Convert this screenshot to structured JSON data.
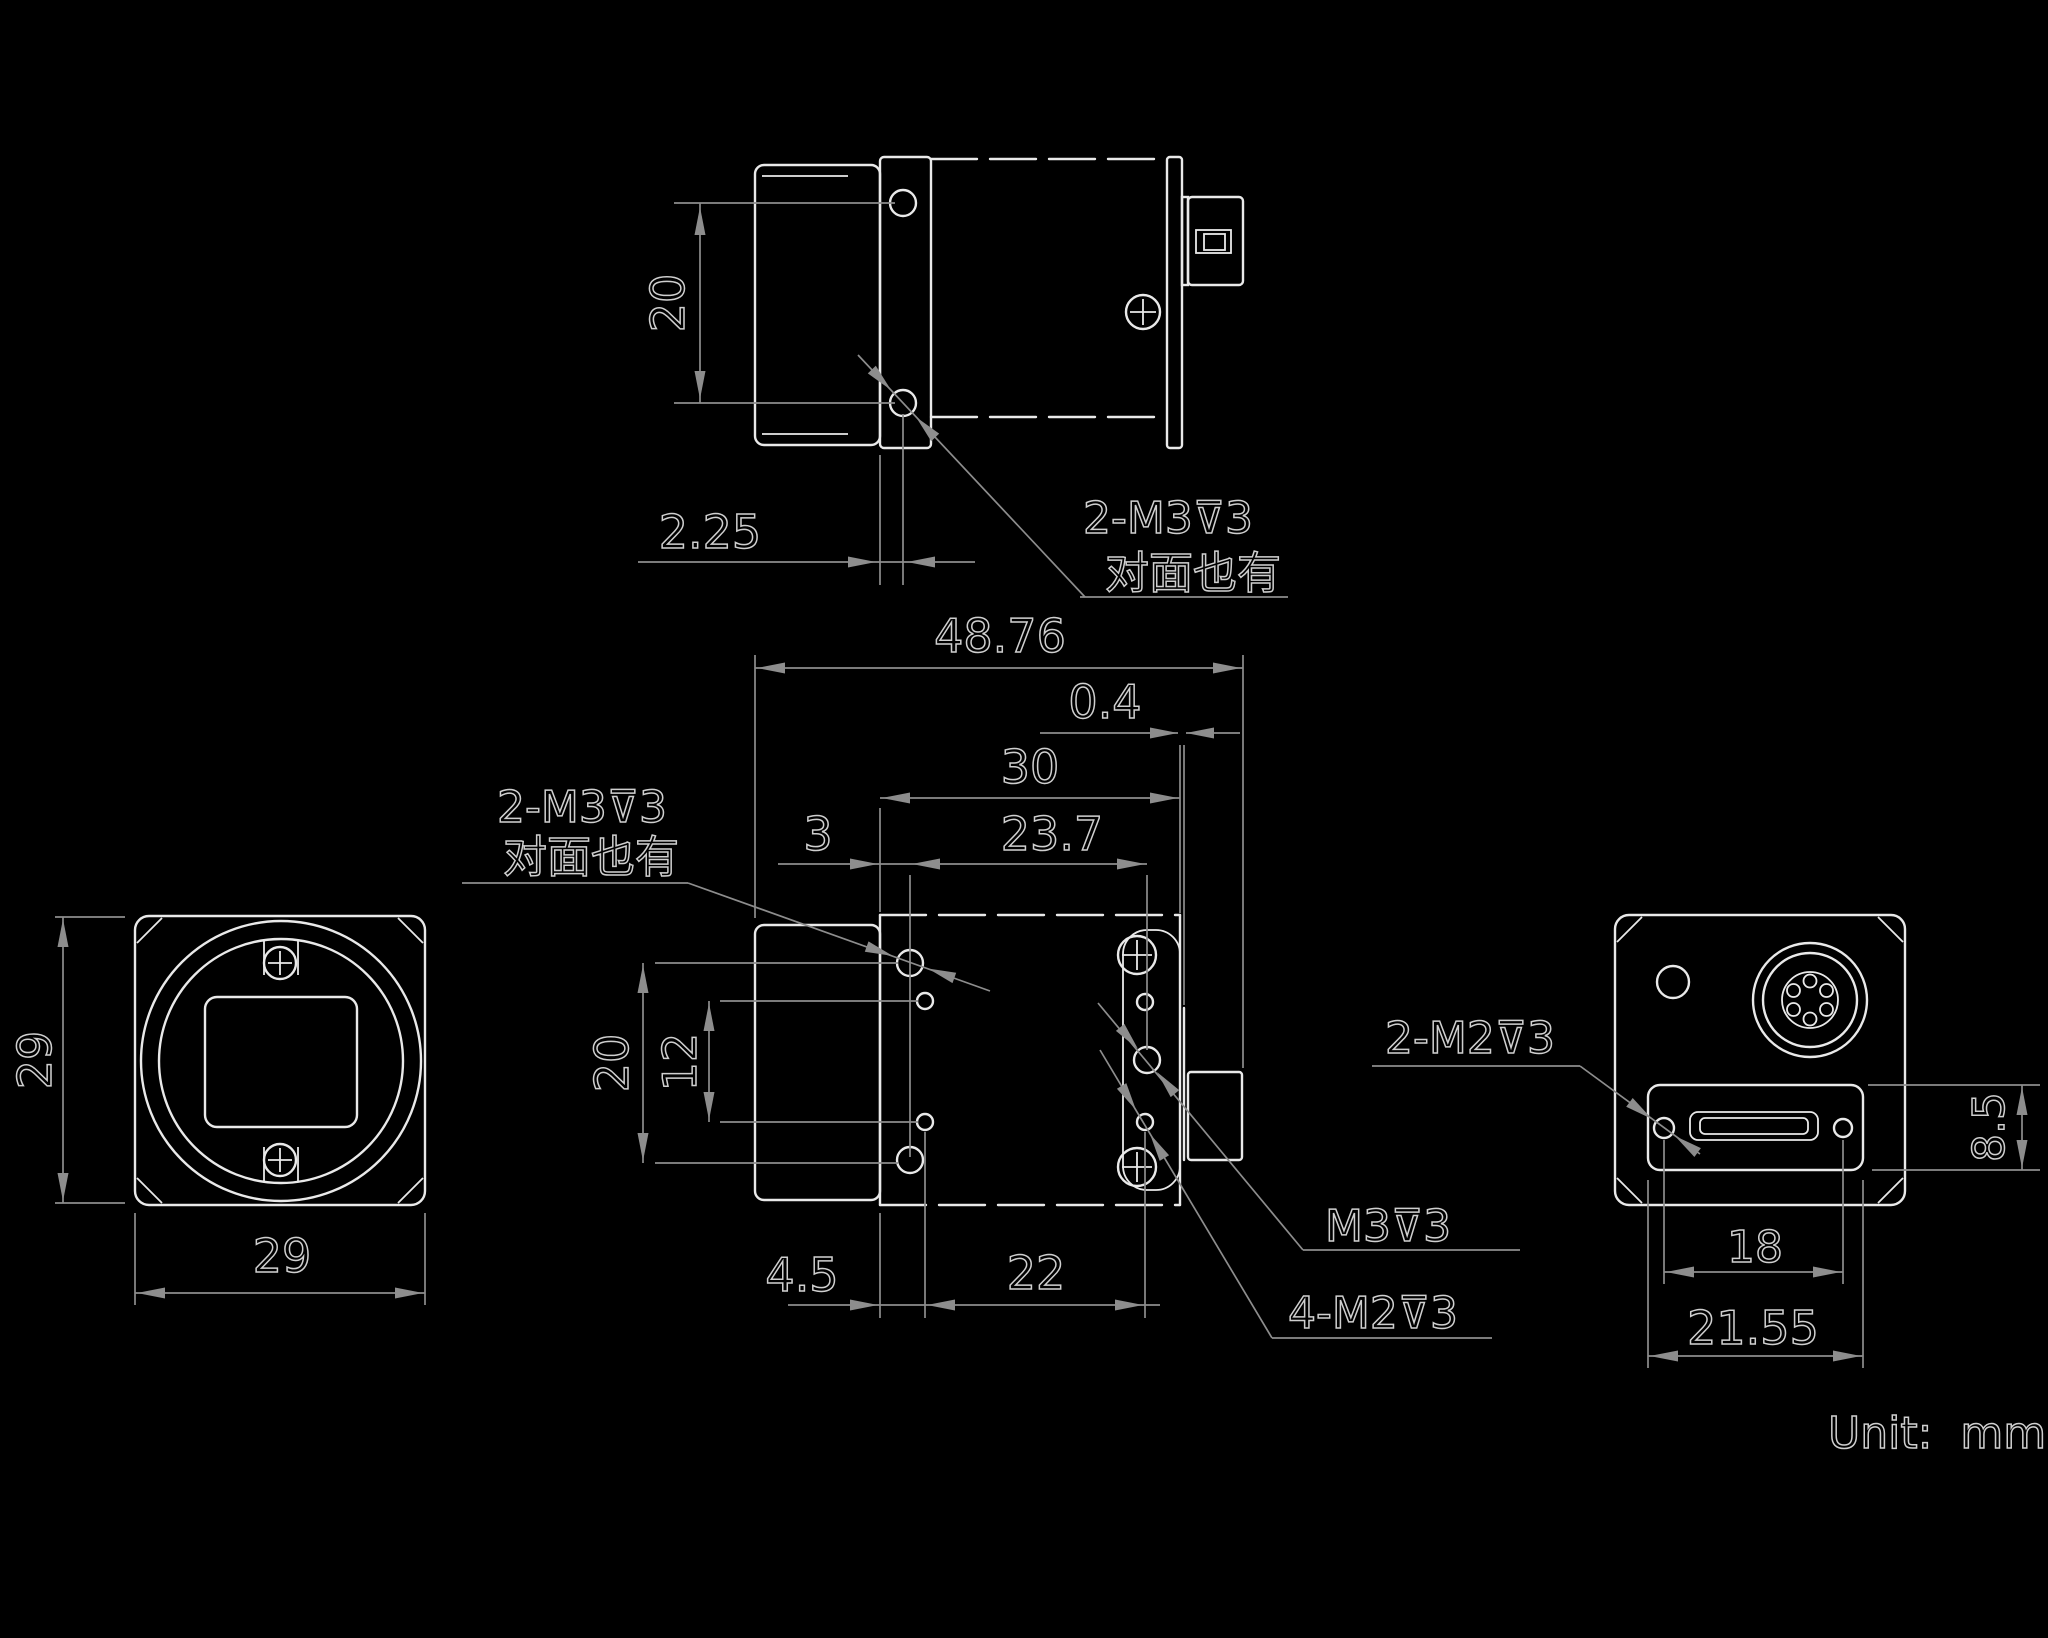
{
  "drawing": {
    "unit_note": "Unit:  mm",
    "top_view": {
      "dim_hole_span_v": "20",
      "dim_hole_offset": "2.25",
      "thread_label": "2-M3⊽3",
      "thread_note": "对面也有"
    },
    "side_view": {
      "dim_total_length": "48.76",
      "dim_rear_plate": "0.4",
      "dim_body_length": "30",
      "dim_m3_span_h": "23.7",
      "dim_front_plate": "3",
      "dim_m3_span_v": "20",
      "dim_m2_span_v": "12",
      "dim_m2_offset": "4.5",
      "dim_m2_span_h": "22",
      "thread_label": "2-M3⊽3",
      "thread_note": "对面也有",
      "m3_label": "M3⊽3",
      "m2_label": "4-M2⊽3"
    },
    "front_view": {
      "dim_height": "29",
      "dim_width": "29"
    },
    "back_view": {
      "dim_recess_height": "8.5",
      "dim_screw_span": "18",
      "dim_recess_width": "21.55",
      "thread_label": "2-M2⊽3"
    },
    "colors": {
      "background": "#000000",
      "object_line": "#e9e9e9",
      "dimension_line": "#8d8d8d",
      "text": "#cfcfcf"
    }
  }
}
